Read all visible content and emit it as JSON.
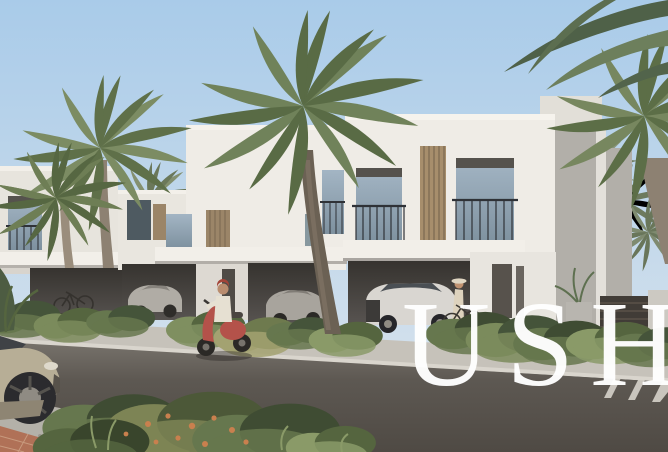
{
  "image": {
    "kind": "real-estate architectural rendering",
    "scene": "Row of modern white two-storey townhouses with open carports on a landscaped palm-lined street; white SUV and silver sedans parked under carports; woman with bicycle by the entrance; person riding a red scooter on the road; champagne car in lower-left foreground; brick pavers, gravel strip and flowering shrubs in front; crosswalk stripes at lower right",
    "objects": [
      "sky",
      "palm-trees",
      "townhouses",
      "carports",
      "white-suv",
      "silver-sedan",
      "silver-sedan-2",
      "bicycle",
      "woman-with-bicycle",
      "scooter-rider",
      "champagne-car",
      "shrub-beds",
      "flowering-bushes",
      "road",
      "crosswalk",
      "planter",
      "timber-slat-fence",
      "boundary-wall"
    ]
  },
  "watermark": {
    "text": "USH",
    "color": "#ffffff",
    "note": "large white serif watermark, last letter clipped by right edge"
  },
  "palette": {
    "sky_top": "#a9cbe9",
    "sky_horizon": "#d2e0ec",
    "wall_sunlit": "#efece6",
    "wall_light": "#e7e4dd",
    "wall_shadow": "#b2afa9",
    "fascia_white": "#f2efe9",
    "carport_interior": "#4c4945",
    "timber_louver": "#a78e6c",
    "window_glass": "#93a6b6",
    "railing_dark": "#2f3237",
    "road_far": "#77726b",
    "road_near": "#4f4a44",
    "pavement": "#c6c2ba",
    "gravel": "#b4b1a9",
    "brick_paver": "#b07157",
    "foliage_dark": "#45543a",
    "foliage_mid": "#66774e",
    "foliage_light": "#8a9a68",
    "palm_light": "#7c8c63",
    "palm_dark": "#5c6e47",
    "palm_trunk": "#857a6b",
    "scooter_red": "#b4524a",
    "suv_white": "#d9d6d1",
    "sedan_silver": "#a8a49d",
    "car_champagne": "#b7ae96",
    "flower_orange": "#c9804e"
  }
}
